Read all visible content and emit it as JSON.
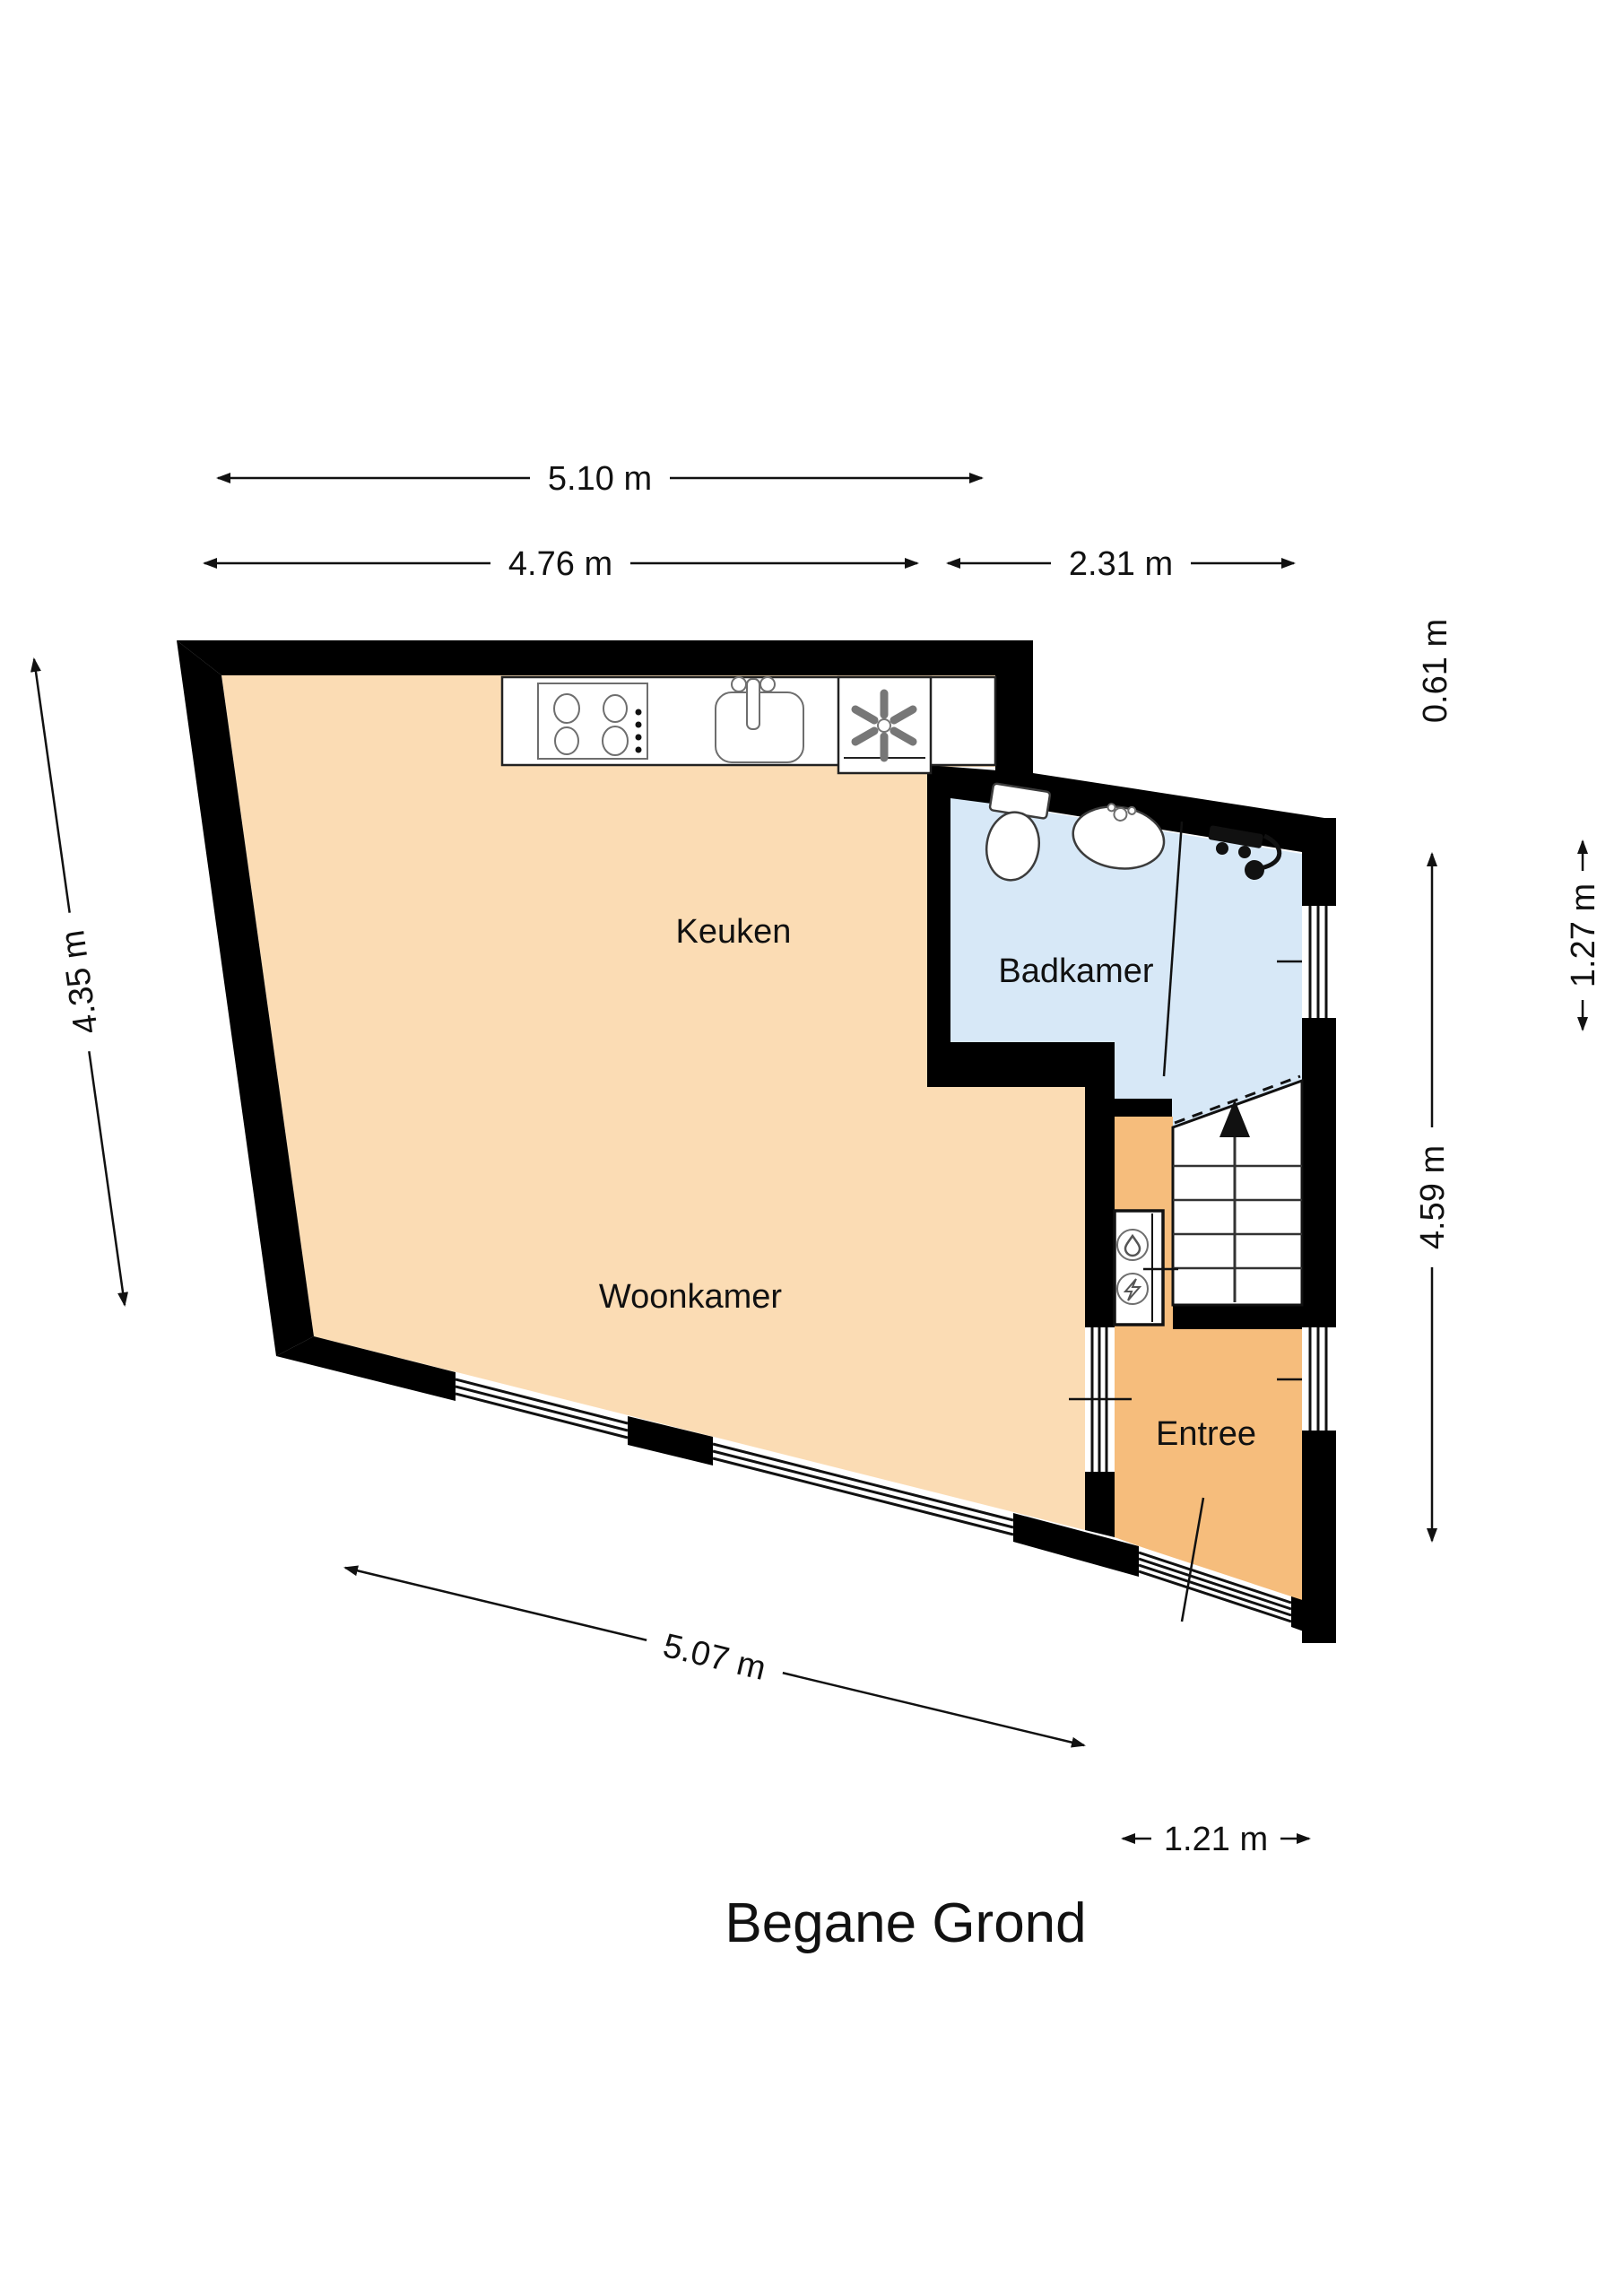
{
  "title": "Begane Grond",
  "rooms": {
    "keuken": "Keuken",
    "woonkamer": "Woonkamer",
    "badkamer": "Badkamer",
    "entree": "Entree"
  },
  "dimensions": {
    "top_total": "5.10 m",
    "top_left_interior": "4.76 m",
    "top_right_bathroom": "2.31 m",
    "left_wall": "4.35 m",
    "right_step": "0.61 m",
    "right_bathroom": "1.27 m",
    "right_total": "4.59 m",
    "bottom_wall": "5.07 m",
    "front_door": "1.21 m"
  },
  "colors": {
    "wall": "#000000",
    "floor_living": "#fbdcb4",
    "floor_entree": "#f6bd7c",
    "floor_bathroom": "#d7e8f7",
    "text": "#111111"
  },
  "fixtures": [
    "stove-icon",
    "kitchen-sink-icon",
    "ventilation-icon",
    "toilet-icon",
    "washbasin-icon",
    "shower-mixer-icon",
    "water-meter-icon",
    "electricity-meter-icon",
    "stairs-up-arrow-icon",
    "door-swing",
    "window"
  ]
}
